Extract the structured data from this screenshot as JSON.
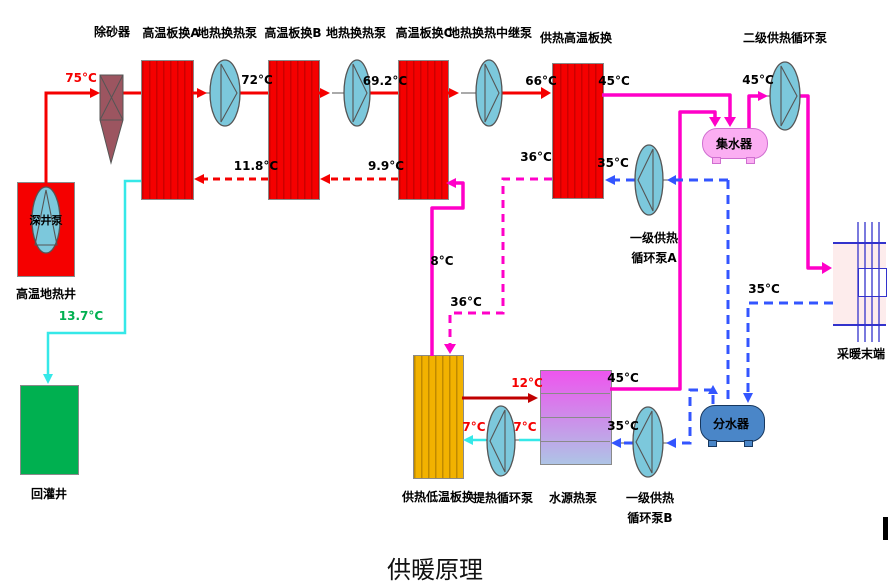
{
  "title": "供暖原理",
  "colors": {
    "hot-red": "#f50000",
    "stripe-red": "#cc0000",
    "dark-red": "#c00000",
    "magenta": "#ff00c8",
    "blue": "#3355ff",
    "cyan": "#35e8e8",
    "pump-fill": "#7cc8dc",
    "maroon": "#9c5560",
    "yellow": "#f2b200",
    "stripe-yellow": "#c08a00",
    "green-well": "#00b050",
    "green-text": "#00b050",
    "collector-pink": "#fbaef2",
    "distributor-blue": "#4a86c8",
    "terminal-pink": "#fdecec",
    "terminal-line": "#3333cc",
    "wshp-top": "#ee55ee",
    "wshp-bottom": "#aec4e6"
  },
  "components": {
    "sand_remover": {
      "label": "除砂器"
    },
    "hx_a": {
      "label": "高温板换A"
    },
    "pump_geo1": {
      "label": "地热换热泵"
    },
    "hx_b": {
      "label": "高温板换B"
    },
    "pump_geo2": {
      "label": "地热换热泵"
    },
    "hx_c": {
      "label": "高温板换C"
    },
    "pump_relay": {
      "label": "地热换热中继泵"
    },
    "hx_supply": {
      "label": "供热高温板换"
    },
    "pump_secondary": {
      "label": "二级供热循环泵"
    },
    "collector": {
      "label": "集水器"
    },
    "pump_primary_a": {
      "label1": "一级供热",
      "label2": "循环泵A"
    },
    "terminal": {
      "label": "采暖末端"
    },
    "deep_well_pump": {
      "label": "深井泵"
    },
    "geothermal_well": {
      "label": "高温地热井"
    },
    "reinjection_well": {
      "label": "回灌井"
    },
    "hx_low": {
      "label": "供热低温板换"
    },
    "pump_extract": {
      "label": "提热循环泵"
    },
    "wshp": {
      "label": "水源热泵"
    },
    "pump_primary_b": {
      "label1": "一级供热",
      "label2": "循环泵B"
    },
    "distributor": {
      "label": "分水器"
    }
  },
  "temps": {
    "supply_75": "75°C",
    "after_a": "72°C",
    "after_b": "69.2°C",
    "after_c": "66°C",
    "hx_supply_out": "45°C",
    "collector_out": "45°C",
    "return_ab": "11.8°C",
    "return_bc": "9.9°C",
    "hx_supply_cold_out": "36°C",
    "hx_supply_cold_in": "35°C",
    "low_to_c": "8°C",
    "low_in": "36°C",
    "reinjection": "13.7°C",
    "low_to_wshp": "12°C",
    "wshp_out": "45°C",
    "extract_a": "7°C",
    "extract_b": "7°C",
    "wshp_return": "35°C",
    "terminal_return": "35°C"
  }
}
